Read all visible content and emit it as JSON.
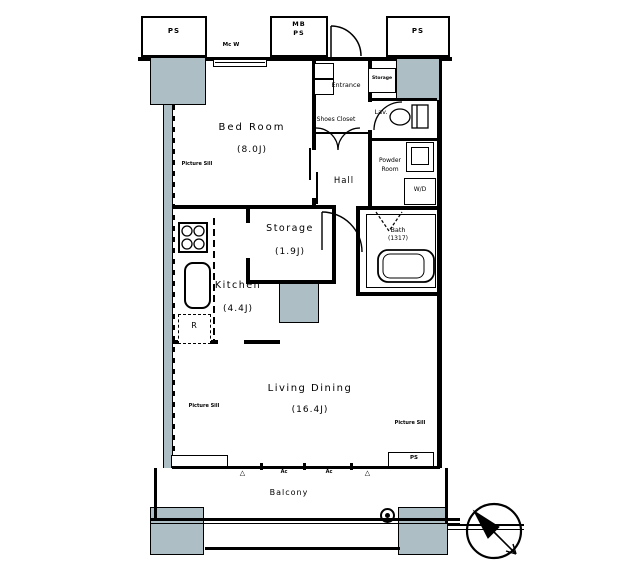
{
  "colors": {
    "line": "#000000",
    "column": "#adbec4",
    "bg": "#ffffff"
  },
  "rooms": {
    "bedroom": {
      "name": "Bed Room",
      "size": "(8.0J)"
    },
    "kitchen": {
      "name": "Kitchen",
      "size": "(4.4J)"
    },
    "storage": {
      "name": "Storage",
      "size": "(1.9J)"
    },
    "living": {
      "name": "Living Dining",
      "size": "(16.4J)"
    },
    "hall": {
      "name": "Hall"
    },
    "entrance": {
      "name": "Entrance"
    },
    "shoes_closet": {
      "name": "Shoes Closet"
    },
    "lav": {
      "name": "Lav."
    },
    "powder": {
      "line1": "Powder",
      "line2": "Room"
    },
    "bath": {
      "name": "Bath",
      "size": "(1317)"
    },
    "balcony": {
      "name": "Balcony"
    }
  },
  "fixtures": {
    "washer_dryer": "W/D",
    "refrigerator": "R",
    "entrance_storage": "Storage"
  },
  "shafts": {
    "ps_top_left": "PS",
    "mb": "MB",
    "mb_ps": "PS",
    "ps_top_right": "PS",
    "ps_balcony": "PS"
  },
  "annotations": {
    "picture_sill": "Picture Sill",
    "ac_unit": "Ac",
    "meter": "Mc W",
    "triangle": "△"
  }
}
